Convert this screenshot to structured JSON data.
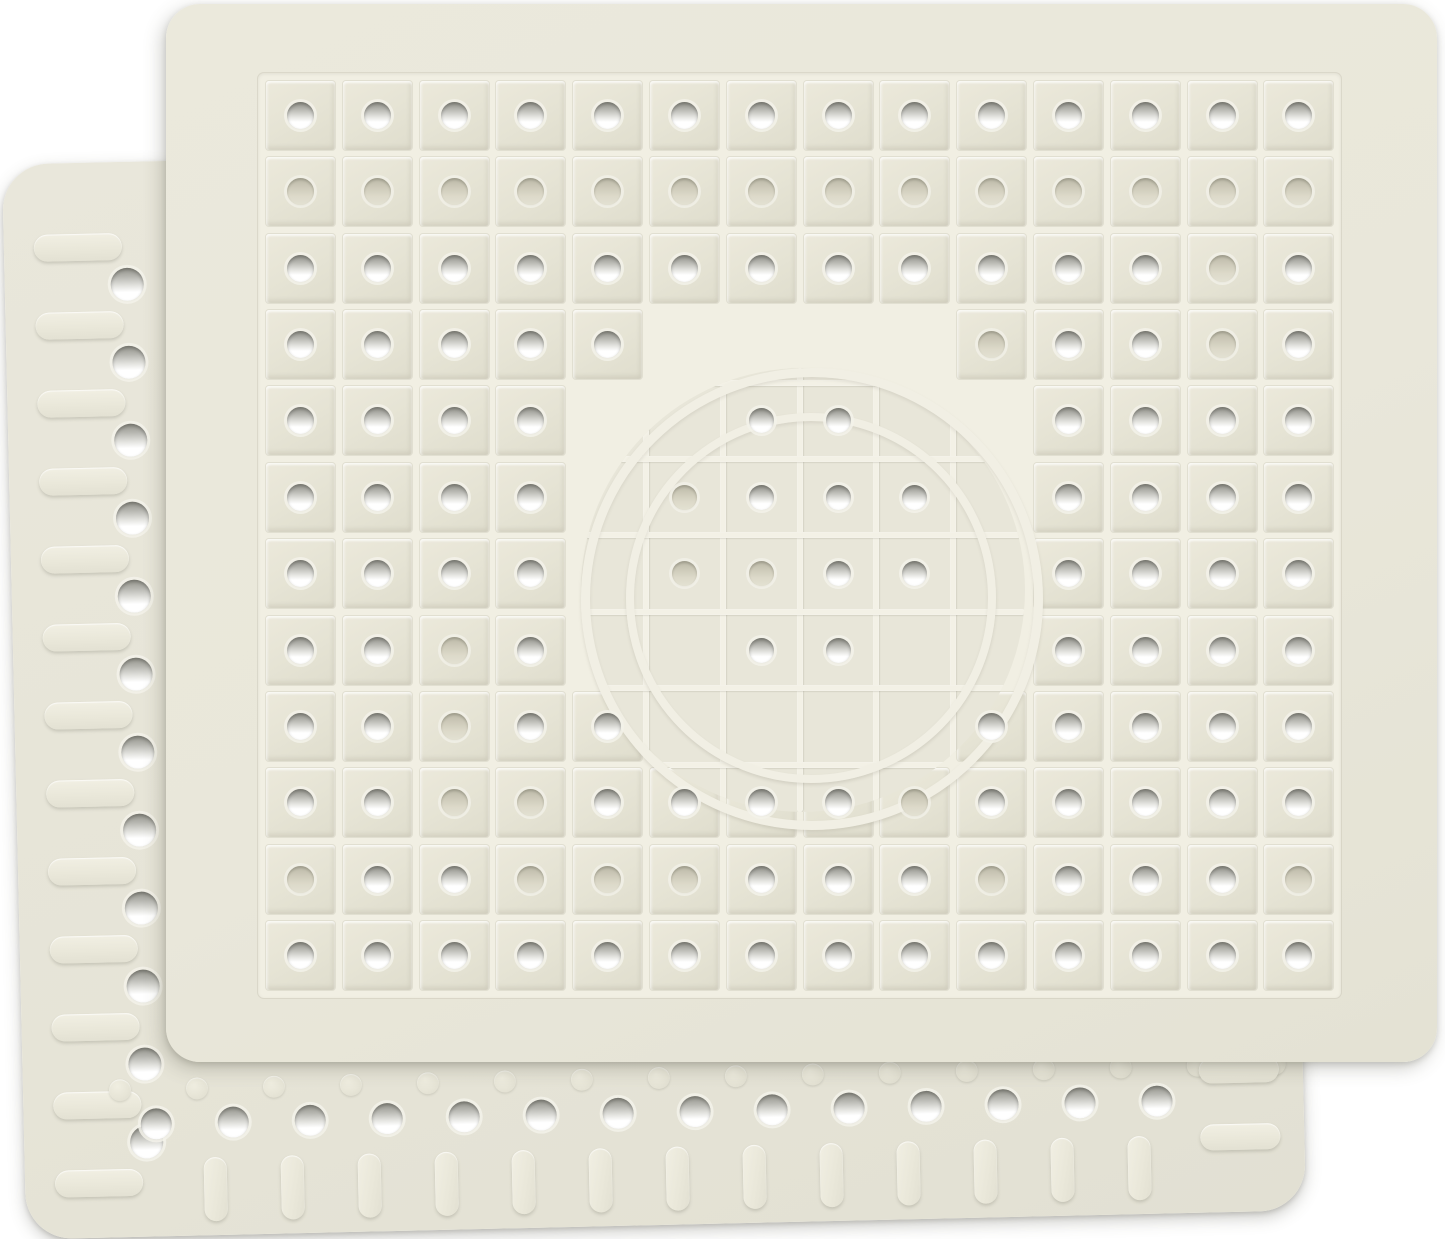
{
  "meta": {
    "description": "Product photo: two cream rubber sink protector mats overlapping on a white background",
    "item_count": 2
  },
  "colors": {
    "background": "#ffffff",
    "front_mat_base": "#e9e7da",
    "back_mat_base": "#e6e4d7",
    "groove_highlight": "#f1efe3",
    "tile_face": "#e5e3d4",
    "ridge_line": "#f3f1e6",
    "hole_white": "#ffffff",
    "hole_shadow_gray": "#94948c",
    "hole_beige": "#cfccbb"
  },
  "front_mat": {
    "left": 166,
    "top": 4,
    "width": 1271,
    "height": 1058,
    "radius": 34,
    "grid": {
      "left": 96,
      "top": 73,
      "cols": 14,
      "rows": 12,
      "pitch_x": 76.8,
      "pitch_y": 76.4,
      "tile_size": 69,
      "hole_d": 27,
      "hole_small_d": 25,
      "map": [
        "WWWWWWWWWWWWWW",
        "BBBBBBBBBBBBBB",
        "WWWWWWWWWWWWBW",
        "WWWWWNNNNBWWBW",
        "WWWWNNwwNNWWWW",
        "WWWWNbwwwNWWWW",
        "WWWWNbbwwNWWWW",
        "WWBWNNwwNNWWWW",
        "WWBWWNNNNWWWWW",
        "WWBBWWWWBWWWWW",
        "BWWBBBWWWBWWWB",
        "WWWWWWWWWWWWWW"
      ]
    },
    "emblem": {
      "cx": 637,
      "cy": 586,
      "outer_r": 222,
      "outer_w": 9,
      "inner_r": 177,
      "inner_w": 8,
      "line_w": 6
    }
  },
  "back_mat": {
    "left": 14,
    "top": 150,
    "width": 1280,
    "height": 1075,
    "radius": 46,
    "rotate_deg": -1.3,
    "left_slots": {
      "cx": 74,
      "cy_start": 84,
      "count": 13,
      "pitch": 78,
      "w": 88,
      "h": 27
    },
    "left_holes": {
      "cx": 122,
      "cy_start": 122,
      "count": 12,
      "pitch": 78,
      "d": 33
    },
    "bottom_bumps": {
      "cy": 928,
      "cx_start": 97,
      "count": 16,
      "pitch": 77,
      "d": 22
    },
    "bottom_holes": {
      "cy": 962,
      "cx_start": 132,
      "count": 14,
      "pitch": 77,
      "d": 31
    },
    "bottom_pills": {
      "y_top": 997,
      "cx_start": 190,
      "count": 13,
      "pitch": 77,
      "w": 23,
      "h": 64
    },
    "right_slots": {
      "x": 1176,
      "ys": [
        920,
        987
      ],
      "w": 80,
      "h": 26
    }
  }
}
